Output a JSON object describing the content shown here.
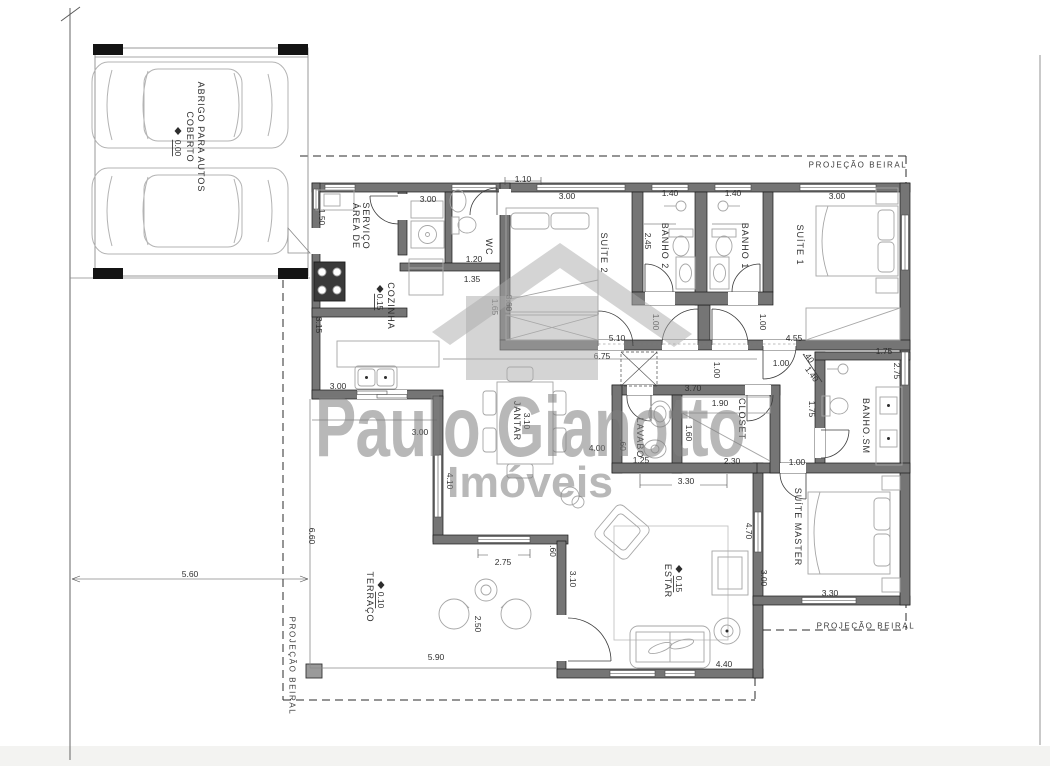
{
  "title": "Planta baixa - residência",
  "watermark": {
    "line1": "Paulo Gianotto",
    "line2": "Imóveis"
  },
  "colors": {
    "wall_fill": "#757575",
    "outline": "#1b1b1b",
    "furniture": "#a6a6a6",
    "text": "#2f2f2f",
    "watermark": "#7d7d7d",
    "eave_dash": "#2b2b2b"
  },
  "plan": {
    "rooms": [
      {
        "id": "abrigo-line1",
        "t": "ABRIGO PARA AUTOS",
        "x": 201,
        "y": 137,
        "r": 90
      },
      {
        "id": "abrigo-line2",
        "t": "COBERTO",
        "x": 190,
        "y": 137,
        "r": 90
      },
      {
        "id": "abrigo-level",
        "t": "0.00",
        "x": 178,
        "y": 148,
        "r": 90,
        "u": 1,
        "dim": 1
      },
      {
        "id": "area-servico-1",
        "t": "ÁREA DE",
        "x": 356,
        "y": 226,
        "r": 90
      },
      {
        "id": "area-servico-2",
        "t": "SERVIÇO",
        "x": 366,
        "y": 226,
        "r": 90
      },
      {
        "id": "cozinha",
        "t": "COZINHA",
        "x": 391,
        "y": 306,
        "r": 90
      },
      {
        "id": "cozinha-level",
        "t": "0.15",
        "x": 380,
        "y": 302,
        "r": 90,
        "u": 1,
        "dim": 1
      },
      {
        "id": "wc",
        "t": "WC",
        "x": 489,
        "y": 247,
        "r": 90
      },
      {
        "id": "suite2",
        "t": "SUÍTE 2",
        "x": 604,
        "y": 253,
        "r": 90
      },
      {
        "id": "banho2",
        "t": "BANHO 2",
        "x": 665,
        "y": 246,
        "r": 90
      },
      {
        "id": "banho1",
        "t": "BANHO 1",
        "x": 745,
        "y": 246,
        "r": 90
      },
      {
        "id": "suite1",
        "t": "SUÍTE 1",
        "x": 800,
        "y": 245,
        "r": 90
      },
      {
        "id": "jantar",
        "t": "JANTAR",
        "x": 517,
        "y": 421,
        "r": 90
      },
      {
        "id": "jantar-dim",
        "t": "3.10",
        "x": 527,
        "y": 421,
        "r": 90,
        "dim": 1
      },
      {
        "id": "lavabo",
        "t": "LAVABO",
        "x": 640,
        "y": 438,
        "r": 90
      },
      {
        "id": "closet",
        "t": "CLOSET",
        "x": 742,
        "y": 419,
        "r": 90
      },
      {
        "id": "banho-sm",
        "t": "BANHO.SM",
        "x": 866,
        "y": 426,
        "r": 90
      },
      {
        "id": "suite-master",
        "t": "SUÍTE MASTER",
        "x": 798,
        "y": 527,
        "r": 90
      },
      {
        "id": "estar",
        "t": "ESTAR",
        "x": 668,
        "y": 581,
        "r": 90
      },
      {
        "id": "estar-level",
        "t": "0.15",
        "x": 679,
        "y": 584,
        "r": 90,
        "u": 1,
        "dim": 1
      },
      {
        "id": "terraco",
        "t": "TERRAÇO",
        "x": 370,
        "y": 597,
        "r": 90
      },
      {
        "id": "terraco-level",
        "t": "0.10",
        "x": 381,
        "y": 600,
        "r": 90,
        "u": 1,
        "dim": 1
      }
    ],
    "dims": [
      {
        "t": "1.10",
        "x": 523,
        "y": 179
      },
      {
        "t": "3.00",
        "x": 428,
        "y": 199
      },
      {
        "t": "3.00",
        "x": 567,
        "y": 196
      },
      {
        "t": "1.40",
        "x": 670,
        "y": 193
      },
      {
        "t": "1.40",
        "x": 733,
        "y": 193
      },
      {
        "t": "3.00",
        "x": 837,
        "y": 196
      },
      {
        "t": "1.50",
        "x": 322,
        "y": 217,
        "r": 90
      },
      {
        "t": "1.20",
        "x": 474,
        "y": 259
      },
      {
        "t": "1.35",
        "x": 472,
        "y": 279
      },
      {
        "t": "3.15",
        "x": 319,
        "y": 325,
        "r": 90
      },
      {
        "t": "2.45",
        "x": 648,
        "y": 241,
        "r": 90
      },
      {
        "t": "3.60",
        "x": 509,
        "y": 303,
        "r": 90
      },
      {
        "t": "1.65",
        "x": 495,
        "y": 307,
        "r": 90
      },
      {
        "t": "5.10",
        "x": 617,
        "y": 338
      },
      {
        "t": "6.75",
        "x": 602,
        "y": 356
      },
      {
        "t": "4.55",
        "x": 794,
        "y": 338
      },
      {
        "t": "1.00",
        "x": 656,
        "y": 322,
        "r": 90
      },
      {
        "t": "1.00",
        "x": 763,
        "y": 322,
        "r": 90
      },
      {
        "t": "1.00",
        "x": 781,
        "y": 363
      },
      {
        "t": ".40",
        "x": 809,
        "y": 357,
        "r": 55
      },
      {
        "t": "1.40",
        "x": 812,
        "y": 374,
        "r": 55
      },
      {
        "t": "1.75",
        "x": 884,
        "y": 351
      },
      {
        "t": "2.75",
        "x": 897,
        "y": 371,
        "r": 90
      },
      {
        "t": "1.00",
        "x": 717,
        "y": 370,
        "r": 90
      },
      {
        "t": "3.70",
        "x": 693,
        "y": 388
      },
      {
        "t": "1.90",
        "x": 720,
        "y": 403
      },
      {
        "t": "1.60",
        "x": 689,
        "y": 433,
        "r": 90
      },
      {
        "t": "2.30",
        "x": 732,
        "y": 461
      },
      {
        "t": "1.25",
        "x": 641,
        "y": 460
      },
      {
        "t": ".60",
        "x": 623,
        "y": 445,
        "r": 90
      },
      {
        "t": "4.00",
        "x": 597,
        "y": 448
      },
      {
        "t": "3.30",
        "x": 686,
        "y": 481
      },
      {
        "t": "1.75",
        "x": 812,
        "y": 409,
        "r": 90
      },
      {
        "t": "1.00",
        "x": 797,
        "y": 462
      },
      {
        "t": "3.00",
        "x": 338,
        "y": 386
      },
      {
        "t": "3.00",
        "x": 420,
        "y": 432
      },
      {
        "t": "4.10",
        "x": 450,
        "y": 481,
        "r": 90
      },
      {
        "t": "6.60",
        "x": 312,
        "y": 536,
        "r": 90
      },
      {
        "t": "2.75",
        "x": 503,
        "y": 562
      },
      {
        "t": ".60",
        "x": 553,
        "y": 551,
        "r": 90
      },
      {
        "t": "3.10",
        "x": 573,
        "y": 579,
        "r": 90
      },
      {
        "t": "4.70",
        "x": 749,
        "y": 531,
        "r": 90
      },
      {
        "t": "3.00",
        "x": 764,
        "y": 578,
        "r": 90
      },
      {
        "t": "3.30",
        "x": 830,
        "y": 593
      },
      {
        "t": "2.50",
        "x": 478,
        "y": 624,
        "r": 90
      },
      {
        "t": "5.90",
        "x": 436,
        "y": 657
      },
      {
        "t": "4.40",
        "x": 724,
        "y": 664
      },
      {
        "t": "5.60",
        "x": 190,
        "y": 574
      }
    ],
    "notes": [
      {
        "t": "PROJEÇÃO  BEIRAL",
        "x": 858,
        "y": 165
      },
      {
        "t": "PROJEÇÃO  BEIRAL",
        "x": 866,
        "y": 626
      },
      {
        "t": "PROJEÇÃO  BEIRAL",
        "x": 292,
        "y": 666,
        "r": 90
      }
    ]
  }
}
